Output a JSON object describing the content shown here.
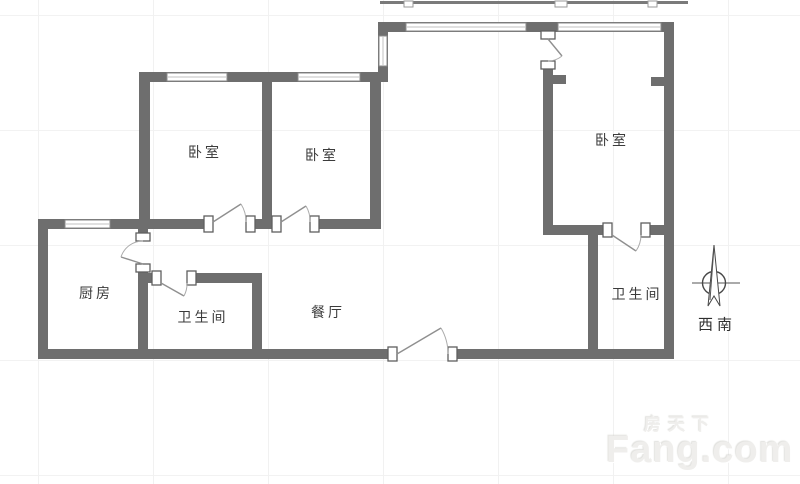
{
  "rooms": [
    {
      "id": "bedroom-1",
      "label": "卧室"
    },
    {
      "id": "bedroom-2",
      "label": "卧室"
    },
    {
      "id": "bedroom-3",
      "label": "卧室"
    },
    {
      "id": "kitchen",
      "label": "厨房"
    },
    {
      "id": "bathroom-1",
      "label": "卫生间"
    },
    {
      "id": "dining-room",
      "label": "餐厅"
    },
    {
      "id": "bathroom-2",
      "label": "卫生间"
    }
  ],
  "compass": {
    "label": "西南",
    "icon": "north-arrow-icon"
  },
  "watermark": {
    "brand_cn": "房天下",
    "brand_en": "Fang.com"
  },
  "colors": {
    "wall": "#6e6e6e",
    "window_frame": "#8a8a8a",
    "door_swing": "#9a9a9a",
    "room_label": "#3b3b3b",
    "compass": "#474747",
    "watermark": "#efeeec",
    "background": "#ffffff",
    "grid": "#f1f1f1"
  }
}
